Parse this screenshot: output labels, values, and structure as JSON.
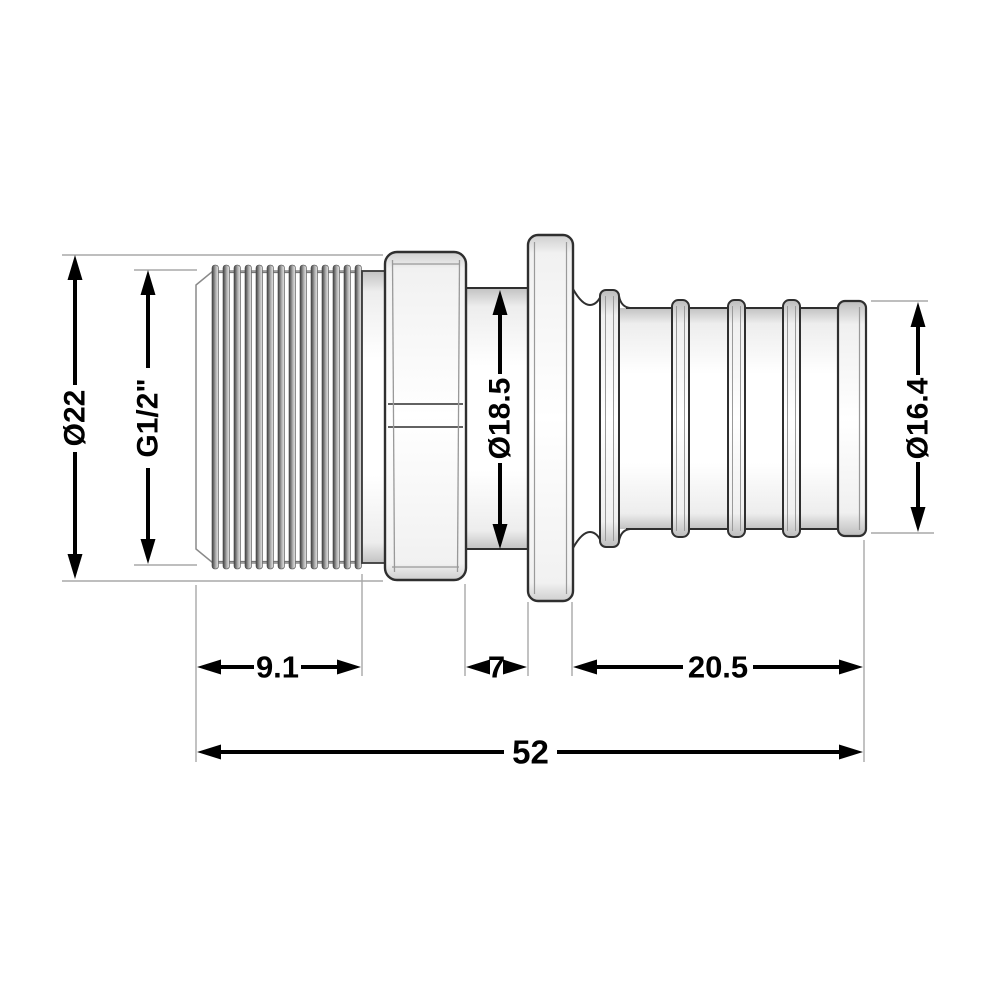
{
  "drawing": {
    "type": "technical-dimension-drawing",
    "part_description": "Male threaded adapter fitting with hex nut, collar flange and barbed pipe tail (side view)",
    "dimensions": {
      "outer_diameter": {
        "label": "Ø22",
        "value": 22,
        "unit": "mm",
        "measures": "thread / hex outer diameter"
      },
      "thread_size": {
        "label": "G1/2\"",
        "value": null,
        "unit": "",
        "measures": "pipe thread designation"
      },
      "collar_diameter": {
        "label": "Ø18.5",
        "value": 18.5,
        "unit": "mm",
        "measures": "neck cylinder diameter"
      },
      "barb_diameter": {
        "label": "Ø16.4",
        "value": 16.4,
        "unit": "mm",
        "measures": "barbed tail diameter"
      },
      "thread_length": {
        "label": "9.1",
        "value": 9.1,
        "unit": "mm",
        "measures": "threaded section length"
      },
      "neck_length": {
        "label": "7",
        "value": 7,
        "unit": "mm",
        "measures": "neck between hex and flange"
      },
      "barb_length": {
        "label": "20.5",
        "value": 20.5,
        "unit": "mm",
        "measures": "barbed tail length"
      },
      "overall_length": {
        "label": "52",
        "value": 52,
        "unit": "mm",
        "measures": "overall fitting length"
      }
    },
    "colors": {
      "background": "#ffffff",
      "dimension_lines": "#000000",
      "part_outline": "#2f2f2f",
      "extension_lines": "#a8a8a8"
    }
  }
}
